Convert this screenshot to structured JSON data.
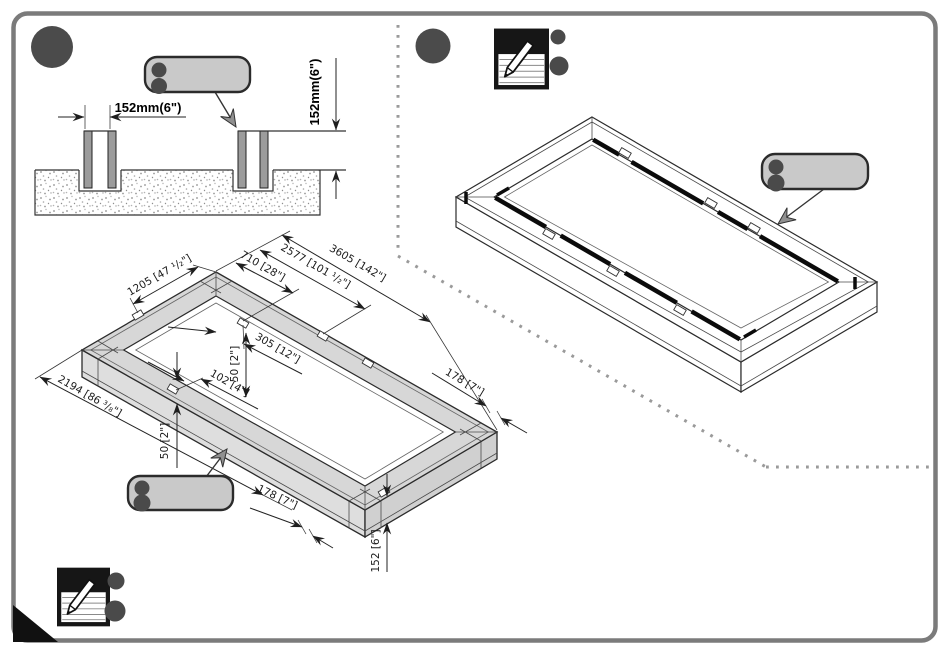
{
  "page": {
    "type": "assembly-instruction-sheet",
    "colors": {
      "border": "#7b7b7b",
      "step_circle": "#4b4b4b",
      "callout_fill": "#c9c9c9",
      "callout_dot": "#4a4a4a",
      "beam_fill": "#d7d7d7",
      "rail_black": "#0b0b0b",
      "dotted_separator": "#9a9a9a",
      "corner_fold": "#111111"
    }
  },
  "trench_section": {
    "gap": "152mm(6\")",
    "depth": "152mm(6\")"
  },
  "foundation_dims": {
    "d1205": "1205 [47 ¹/₂\"]",
    "d710": "710 [28\"]",
    "d2577": "2577 [101 ¹/₂\"]",
    "d3605": "3605 [142\"]",
    "d305": "305 [12\"]",
    "d50_center": "50 [2\"]",
    "d102": "102 [4\"]",
    "d2194": "2194 [86 ³/₈\"]",
    "d50_left": "50 [2\"]",
    "d178_bottom": "178 [7\"]",
    "d178_right": "178 [7\"]",
    "d152_height": "152 [6\"]"
  },
  "icons": {
    "note_icon": "notepad-with-pencil",
    "step_marker": "filled-circle",
    "callout_bullets": "two-dots"
  }
}
